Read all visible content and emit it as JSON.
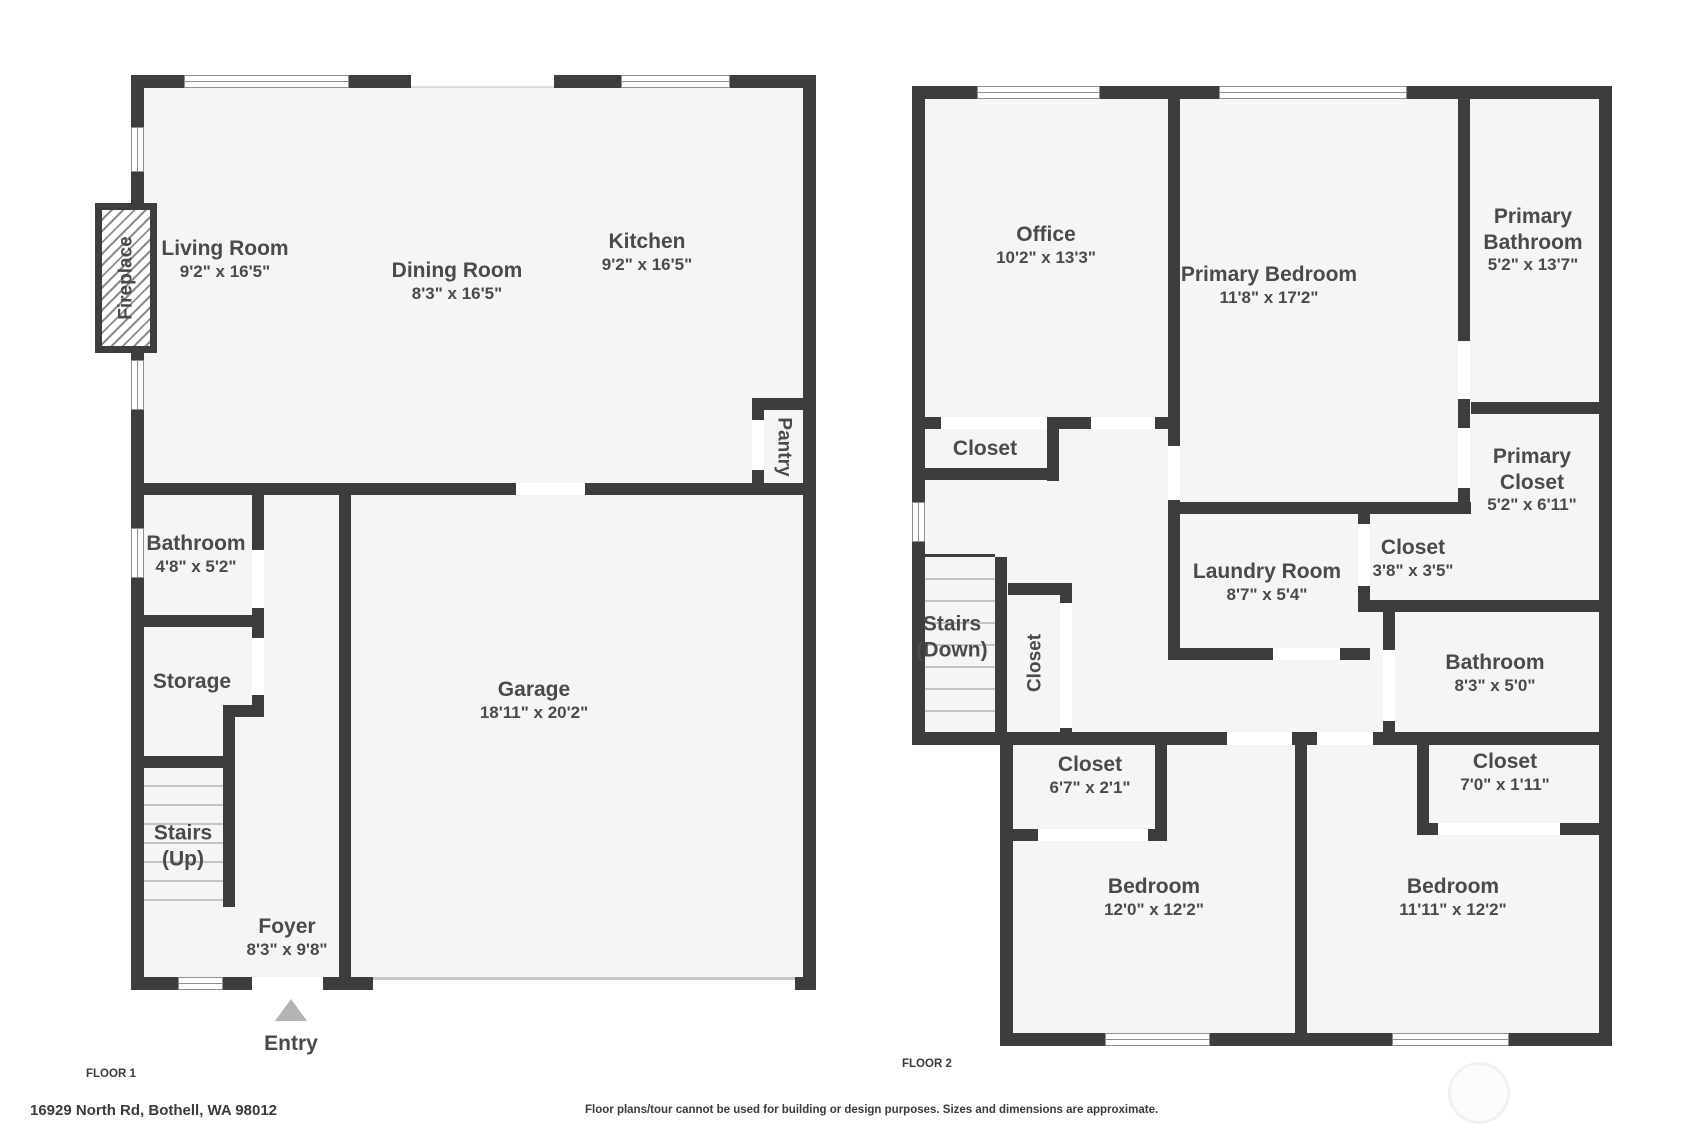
{
  "floor1": {
    "floor_label": "FLOOR 1",
    "entry_label": "Entry",
    "rooms": [
      {
        "name": "Living Room",
        "dims": "9'2\" x 16'5\""
      },
      {
        "name": "Dining Room",
        "dims": "8'3\" x 16'5\""
      },
      {
        "name": "Kitchen",
        "dims": "9'2\" x 16'5\""
      },
      {
        "name": "Pantry"
      },
      {
        "name": "Bathroom",
        "dims": "4'8\" x 5'2\""
      },
      {
        "name": "Storage"
      },
      {
        "name": "Stairs",
        "name2": "(Up)"
      },
      {
        "name": "Foyer",
        "dims": "8'3\" x 9'8\""
      },
      {
        "name": "Garage",
        "dims": "18'11\" x 20'2\""
      },
      {
        "name": "Fireplace"
      }
    ]
  },
  "floor2": {
    "floor_label": "FLOOR 2",
    "rooms": [
      {
        "name": "Office",
        "dims": "10'2\" x 13'3\""
      },
      {
        "name": "Primary Bedroom",
        "dims": "11'8\" x 17'2\""
      },
      {
        "name": "Primary",
        "name2": "Bathroom",
        "dims": "5'2\" x 13'7\""
      },
      {
        "name": "Primary",
        "name2": "Closet",
        "dims": "5'2\" x 6'11\""
      },
      {
        "name": "Closet"
      },
      {
        "name": "Laundry Room",
        "dims": "8'7\" x 5'4\""
      },
      {
        "name": "Closet",
        "dims": "3'8\" x 3'5\""
      },
      {
        "name": "Bathroom",
        "dims": "8'3\" x 5'0\""
      },
      {
        "name": "Stairs",
        "name2": "(Down)"
      },
      {
        "name": "Closet"
      },
      {
        "name": "Closet",
        "dims": "6'7\" x 2'1\""
      },
      {
        "name": "Closet",
        "dims": "7'0\" x 1'11\""
      },
      {
        "name": "Bedroom",
        "dims": "12'0\" x 12'2\""
      },
      {
        "name": "Bedroom",
        "dims": "11'11\" x 12'2\""
      }
    ]
  },
  "footer": {
    "address": "16929 North Rd, Bothell, WA 98012",
    "disclaimer": "Floor plans/tour cannot be used for building or design purposes. Sizes and dimensions are approximate."
  },
  "colors": {
    "wall": "#3d3d3d",
    "room_fill": "#f5f5f5",
    "label_ink": "#4a4a4a",
    "entry_arrow": "#b3b3b3",
    "step_line": "#c4c4c4"
  }
}
